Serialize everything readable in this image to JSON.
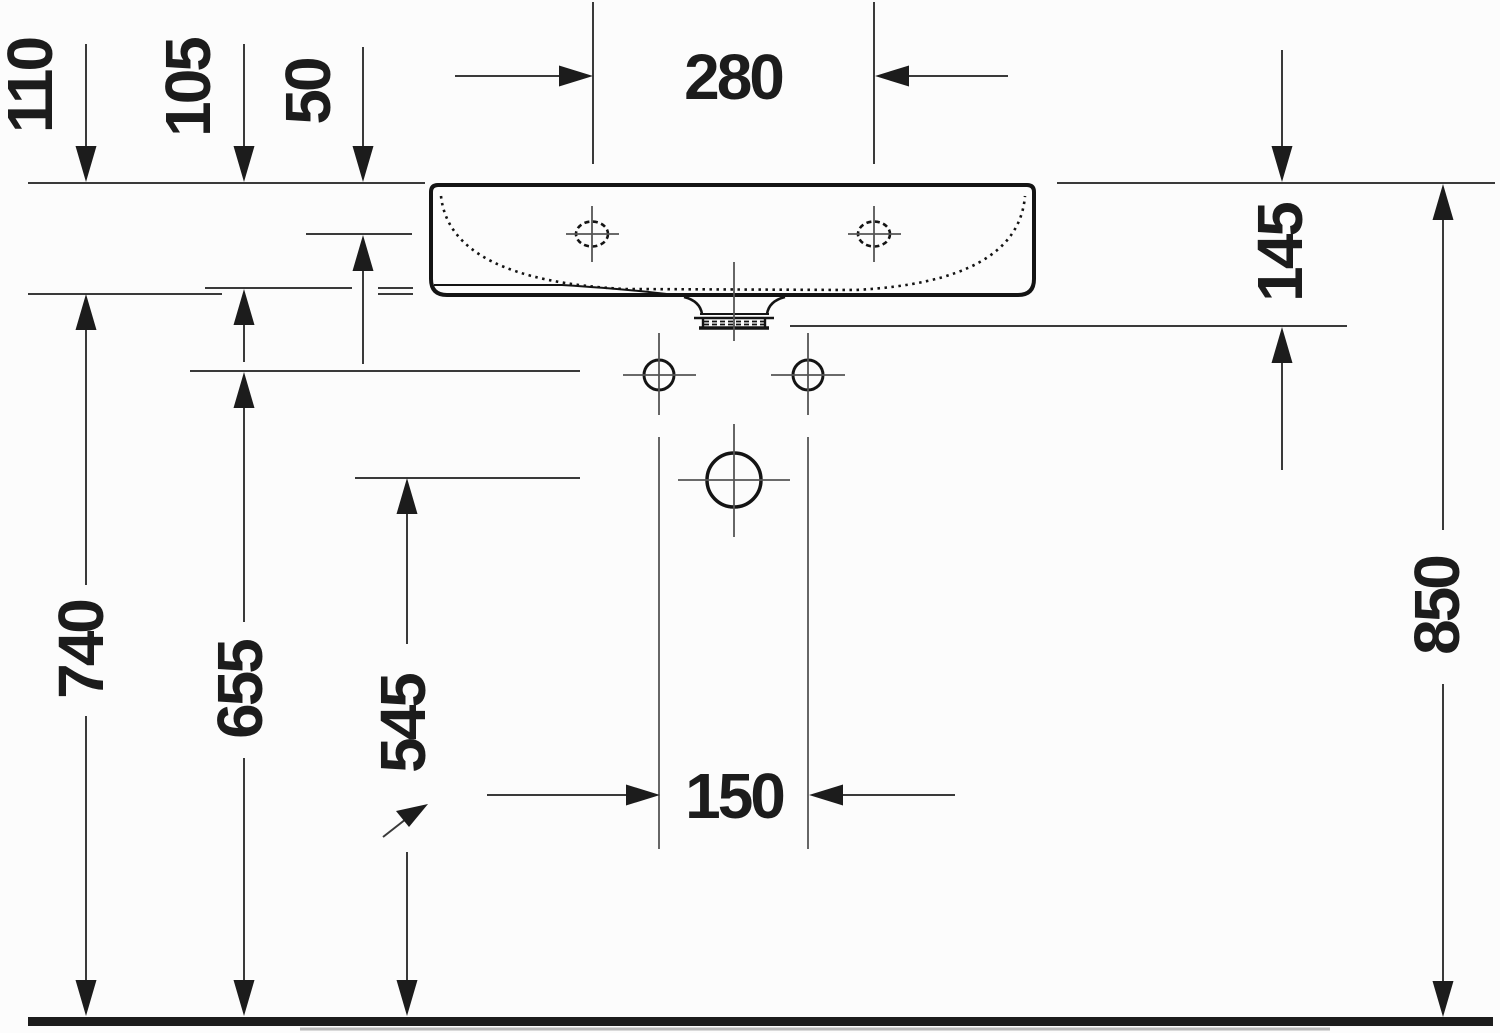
{
  "drawing": {
    "subject": "washbasin-installation-front-elevation",
    "colors": {
      "background": "#fcfcfc",
      "dimension_line": "#3a3a3a",
      "object_outline": "#141414",
      "text": "#1c1c1c"
    },
    "dims": {
      "d110": {
        "label": "110"
      },
      "d105": {
        "label": "105"
      },
      "d50": {
        "label": "50"
      },
      "d280": {
        "label": "280"
      },
      "d145": {
        "label": "145"
      },
      "d740": {
        "label": "740"
      },
      "d655": {
        "label": "655"
      },
      "d545": {
        "label": "545"
      },
      "d150": {
        "label": "150"
      },
      "d850": {
        "label": "850"
      }
    }
  }
}
